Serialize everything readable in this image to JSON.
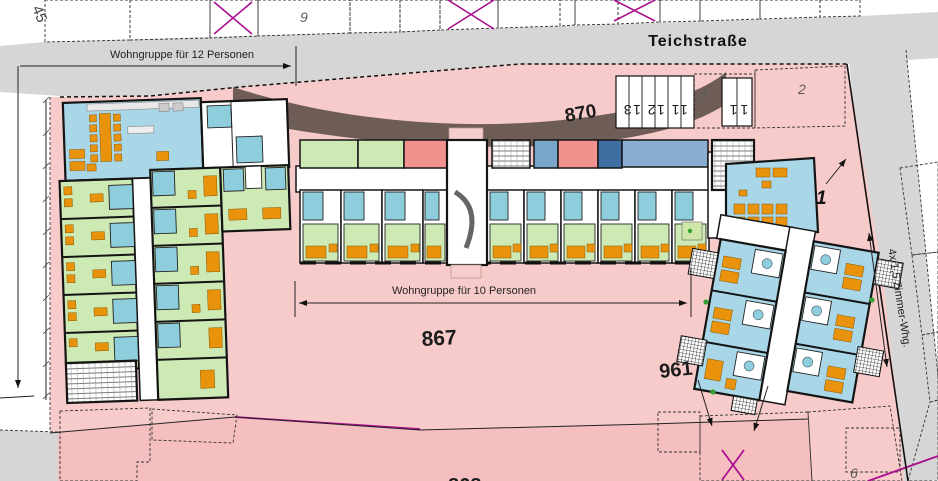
{
  "street": {
    "name": "Teichstraße"
  },
  "annotations": {
    "group12": "Wohngruppe für 12 Personen",
    "group10": "Wohngruppe für 10 Personen",
    "apartments": "4x 1,5 Zimmer-Whg."
  },
  "parcel_labels": {
    "p45": "45",
    "p9": "9",
    "p870": "870",
    "p1_small": "1",
    "p2": "2",
    "p867": "867",
    "p961": "961",
    "p6": "6",
    "p868": "868",
    "building1": "1"
  },
  "house_numbers": {
    "garage_row": "11 12 13",
    "pair": "11"
  },
  "colors": {
    "street_gray": "#d6d6d6",
    "ground_pink": "#f8cbcb",
    "parcel_salmon": "#f2a6a6",
    "parcel_violet": "#f4d9f4",
    "parcel_olive": "#a5a46b",
    "parcel_lightgreen": "#c4e194",
    "band_brown": "#6e5d57",
    "room_common_blue": "#a9d7e8",
    "room_bedroom_green": "#cde9b4",
    "room_red": "#f2928f",
    "room_steel_blue": "#6e9ec6",
    "bath_teal": "#8ecddb",
    "furniture_orange": "#e9930d",
    "boundary_magenta": "#aa0f8f"
  }
}
